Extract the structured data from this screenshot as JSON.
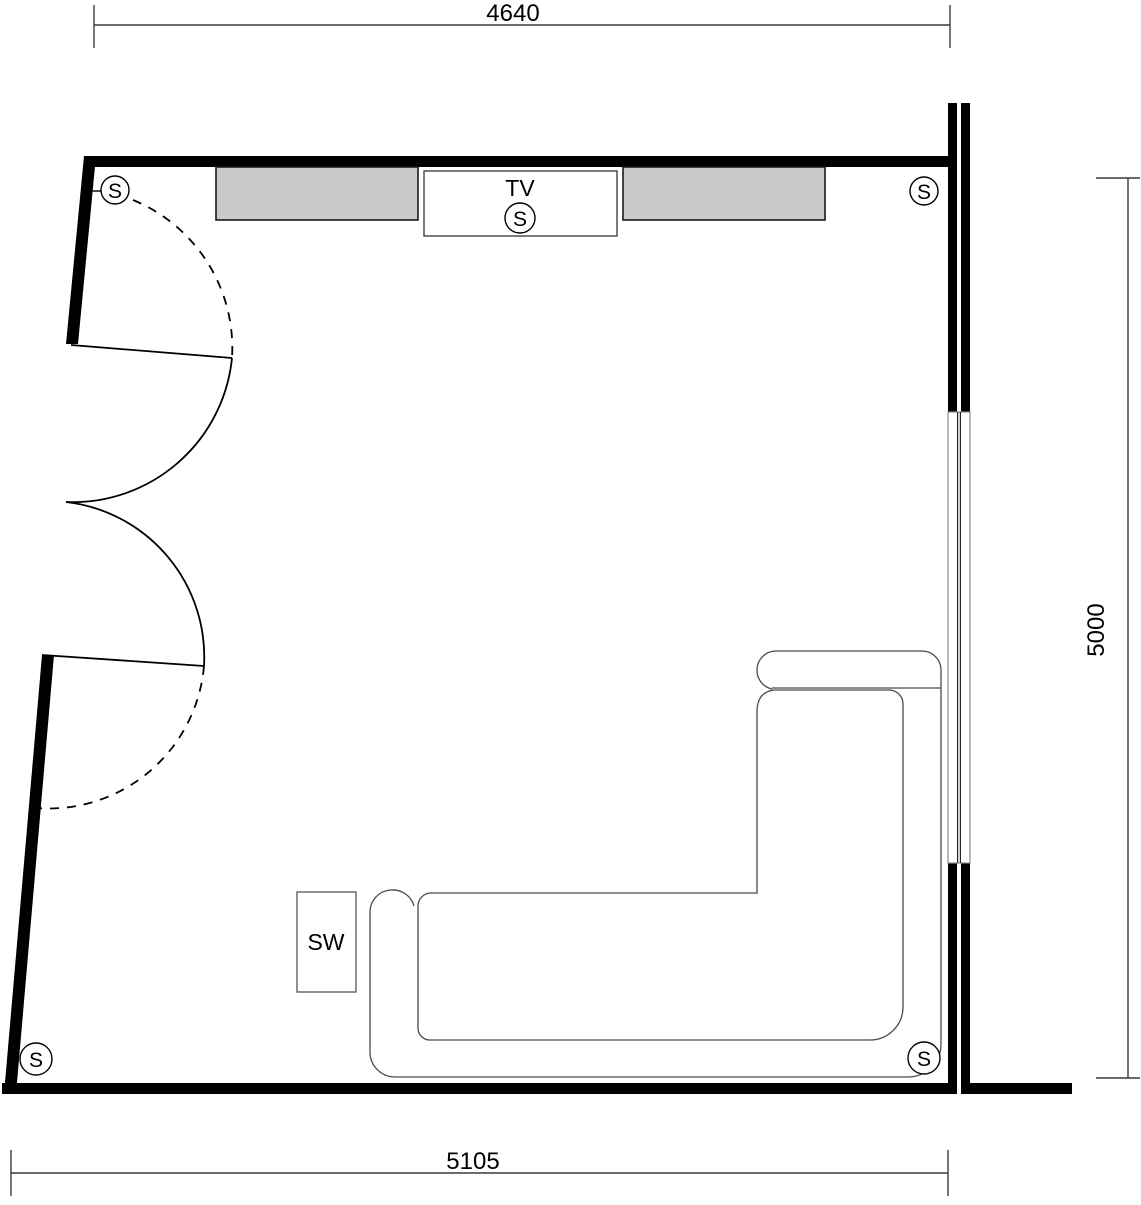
{
  "drawing_type": "room-floor-plan",
  "dimensions": {
    "top": "4640",
    "right": "5000",
    "bottom": "5105"
  },
  "labels": {
    "tv": "TV",
    "subwoofer": "SW",
    "speaker": "S"
  },
  "speakers": {
    "count": 5,
    "positions": [
      "top-left",
      "top-right",
      "bottom-left",
      "bottom-right",
      "tv-center"
    ]
  },
  "colors": {
    "wall": "#000000",
    "cabinet_fill": "#c9c9c9",
    "cabinet_border": "#1a1a1a",
    "furniture_line": "#4a4a4a",
    "window_outer_line": "#888888",
    "window_glass_line": "#222222",
    "dimension_line": "#3a3a3a",
    "text": "#000000",
    "background": "#ffffff"
  }
}
